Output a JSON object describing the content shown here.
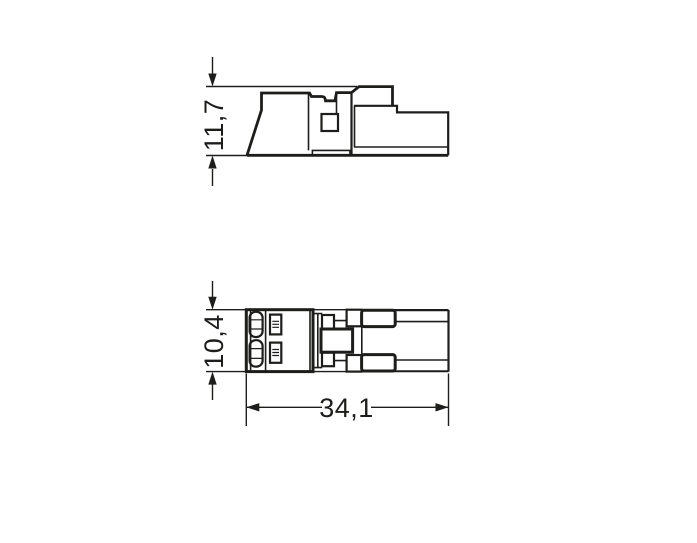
{
  "dimensions": {
    "side_height": {
      "label": "11,7"
    },
    "top_height": {
      "label": "10,4"
    },
    "length": {
      "label": "34,1"
    }
  },
  "colors": {
    "line": "#1d1d1b",
    "text": "#1d1d1b",
    "background": "#ffffff"
  }
}
